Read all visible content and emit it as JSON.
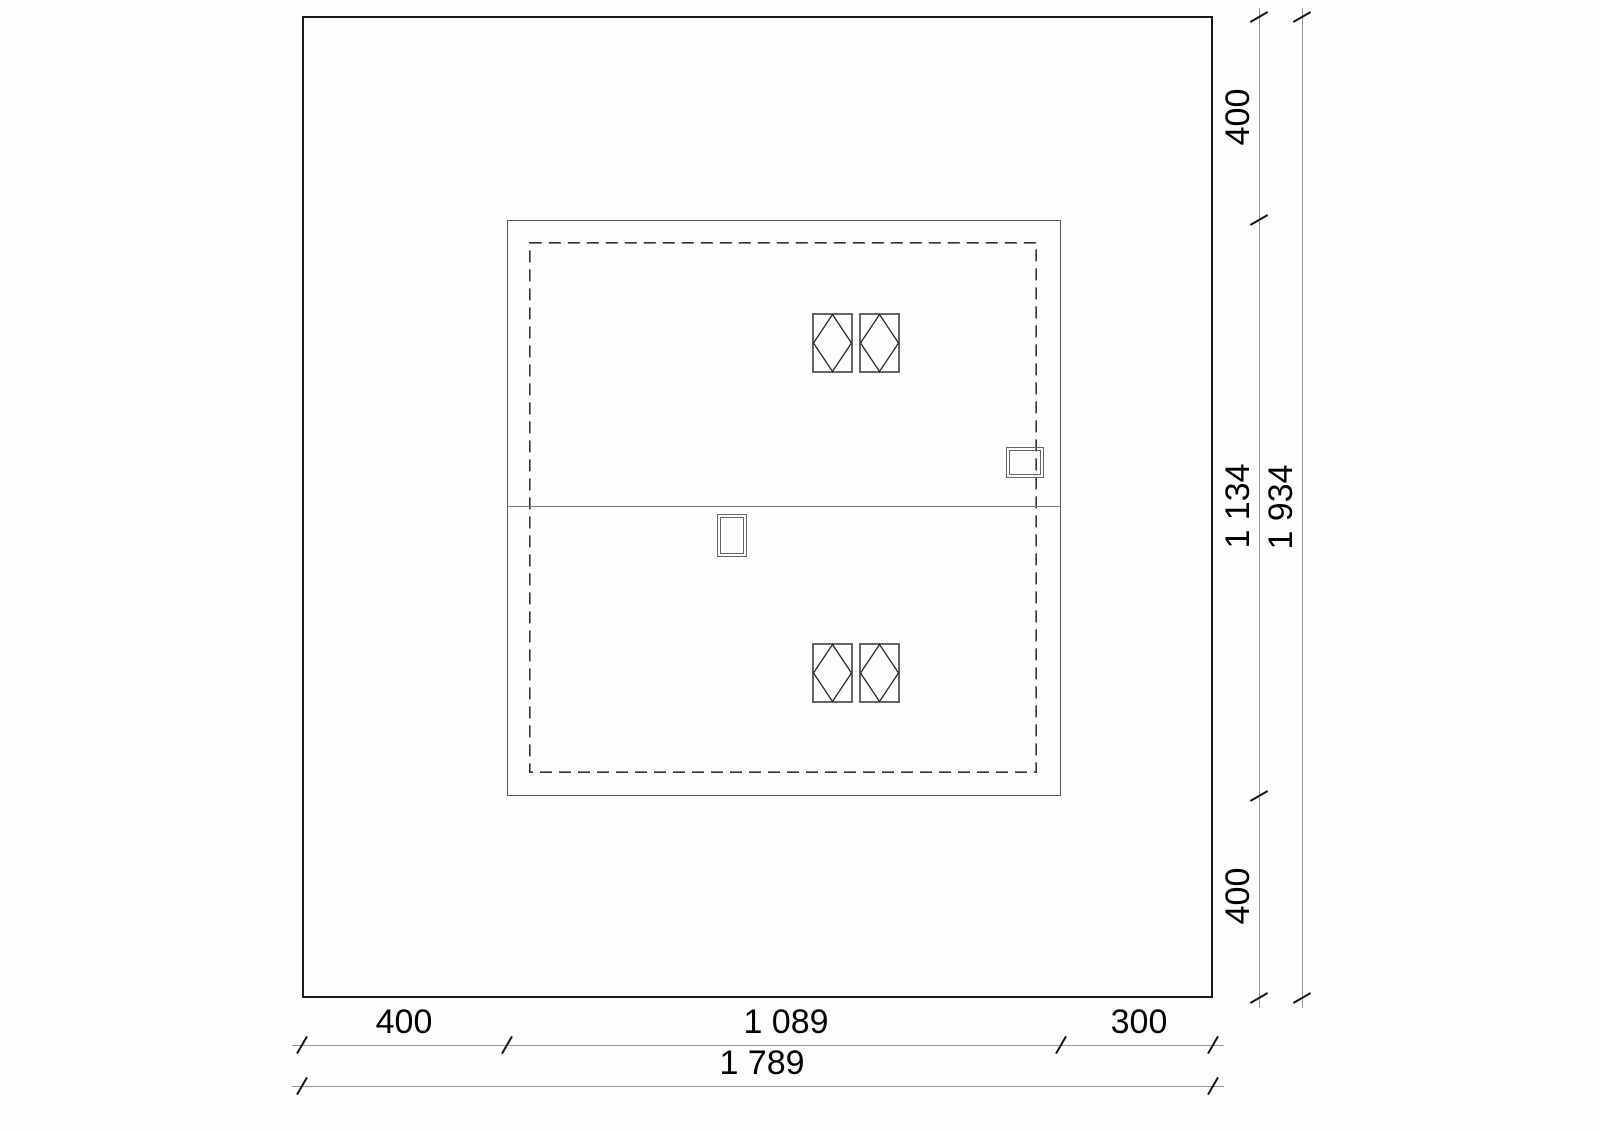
{
  "drawing": {
    "kind": "architectural roof plan with plot boundary and dimension strings",
    "dimensions": {
      "right": {
        "segments": [
          {
            "label": "400"
          },
          {
            "label": "1 134"
          },
          {
            "label": "400"
          }
        ],
        "total": {
          "label": "1 934"
        }
      },
      "bottom": {
        "segments": [
          {
            "label": "400"
          },
          {
            "label": "1 089"
          },
          {
            "label": "300"
          }
        ],
        "total": {
          "label": "1 789"
        }
      }
    },
    "colors": {
      "site_boundary": "#1a1a1a",
      "building_line": "#555555",
      "overhang_dash": "#333333",
      "ridge_line": "#777777",
      "dimension_line": "#979797",
      "tick": "#151515",
      "text": "#000000",
      "background": "#fdfdfd"
    }
  }
}
